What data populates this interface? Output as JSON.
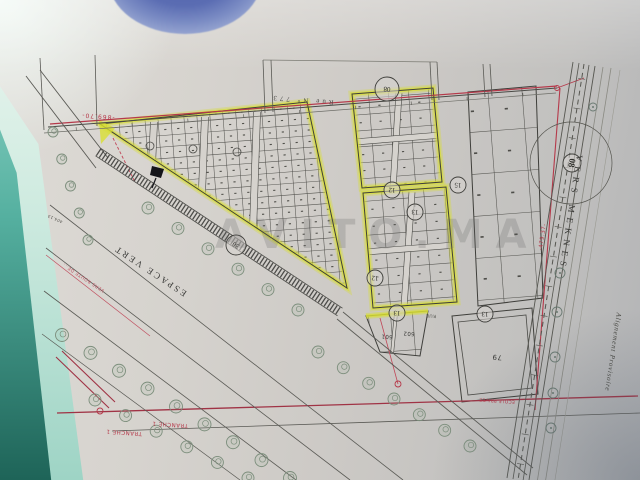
{
  "photo": {
    "watermark": "AVITO.MA",
    "colors": {
      "paper": "#d5d2cd",
      "ink": "#4a4a46",
      "red": "#b5394a",
      "highlighter_yellow": "#d8de33",
      "table_teal": "#2a7a6c",
      "blue_object": "#5b6db3",
      "tree_green": "#7c8e7c"
    }
  },
  "plan": {
    "grid_angle": -4.4,
    "labels": [
      {
        "id": "street-name-top",
        "text": "Rue N° 773",
        "x": 302,
        "y": 100,
        "rot": 184.4,
        "size": 7,
        "color": "#4a4a46",
        "ls": 3,
        "serif": true
      },
      {
        "id": "dimension-869-70",
        "text": "-869.70-",
        "x": 98,
        "y": 116,
        "rot": 184.4,
        "size": 6,
        "color": "#b5394a",
        "ls": 1
      },
      {
        "id": "road-to-meknes",
        "text": "VERS MEKNES",
        "x": 571,
        "y": 213,
        "rot": 98.5,
        "size": 9,
        "color": "#3a3a38",
        "ls": 5,
        "serif": true
      },
      {
        "id": "green-space-label",
        "text": "ESPACE VERT",
        "x": 150,
        "y": 271,
        "rot": 213.5,
        "size": 9,
        "color": "#3a3a38",
        "ls": 2.5,
        "serif": true
      },
      {
        "id": "phase-label-right",
        "text": "TRANCHE 1",
        "x": 170,
        "y": 424,
        "rot": 184,
        "size": 5.5,
        "color": "#b5394a",
        "ls": 0.5
      },
      {
        "id": "phase-label-left",
        "text": "TRANCHE 1",
        "x": 124,
        "y": 432,
        "rot": 184,
        "size": 5.5,
        "color": "#b5394a",
        "ls": 0.5
      },
      {
        "id": "alignment-note",
        "text": "Alignement Provisoire",
        "x": 613,
        "y": 352,
        "rot": 98.5,
        "size": 7,
        "color": "#45453f",
        "ls": 0.8,
        "italic": true,
        "serif": true
      },
      {
        "id": "dimension-479-37",
        "text": "-479.37-",
        "x": 543,
        "y": 237,
        "rot": 278.5,
        "size": 5.5,
        "color": "#b5394a",
        "ls": 0.5
      },
      {
        "id": "road-note-red",
        "text": "VERS ROUTE DE...",
        "x": 84,
        "y": 277,
        "rot": 213.5,
        "size": 4.5,
        "color": "#c05060",
        "ls": 0.5
      },
      {
        "id": "dimension-404-13",
        "text": "404.13",
        "x": 55,
        "y": 219,
        "rot": 204,
        "size": 4,
        "color": "#55554f",
        "ls": 0.3
      },
      {
        "id": "plot-601",
        "text": "601",
        "x": 387,
        "y": 336,
        "rot": 184,
        "size": 5.5,
        "color": "#3a3a38",
        "ls": 0.3
      },
      {
        "id": "plot-602",
        "text": "602",
        "x": 409,
        "y": 333,
        "rot": 184,
        "size": 5.5,
        "color": "#3a3a38",
        "ls": 0.3
      },
      {
        "id": "plot-79",
        "text": "79",
        "x": 497,
        "y": 357,
        "rot": 184,
        "size": 7,
        "color": "#3a3a38",
        "ls": 0.5
      },
      {
        "id": "school-caption",
        "text": "ECOLE PRIVEE",
        "x": 497,
        "y": 400,
        "rot": 184,
        "size": 4.5,
        "color": "#b5394a",
        "ls": 0.3
      },
      {
        "id": "street-label-small",
        "text": "RUE",
        "x": 431,
        "y": 315,
        "rot": 184,
        "size": 4.5,
        "color": "#55554f",
        "ls": 0.5
      }
    ],
    "circled_numbers": [
      {
        "x": 387,
        "y": 89,
        "label": "08",
        "r": 12,
        "rot": 184,
        "bold": false
      },
      {
        "x": 572,
        "y": 163,
        "label": "08",
        "r": 9,
        "rot": 99,
        "bold": true
      },
      {
        "x": 236,
        "y": 245,
        "label": "30",
        "r": 10,
        "rot": 213,
        "bold": false
      },
      {
        "x": 392,
        "y": 190,
        "label": "12",
        "r": 8,
        "rot": 184,
        "bold": false
      },
      {
        "x": 415,
        "y": 212,
        "label": "13",
        "r": 8,
        "rot": 184,
        "bold": false
      },
      {
        "x": 375,
        "y": 278,
        "label": "12",
        "r": 8,
        "rot": 184,
        "bold": false
      },
      {
        "x": 397,
        "y": 313,
        "label": "13",
        "r": 8,
        "rot": 184,
        "bold": false
      },
      {
        "x": 485,
        "y": 314,
        "label": "13",
        "r": 8,
        "rot": 184,
        "bold": false
      },
      {
        "x": 458,
        "y": 185,
        "label": "15",
        "r": 8,
        "rot": 184,
        "bold": false
      }
    ],
    "blocks": [
      {
        "name": "triangle-block",
        "points": [
          [
            100,
            124
          ],
          [
            307,
            102
          ],
          [
            347,
            288
          ]
        ],
        "yellow": true,
        "grid": {
          "cw": 13,
          "ch": 11.5
        },
        "dots": 1.1,
        "streets": [
          [
            154,
            122,
            146,
            290,
            7
          ],
          [
            205,
            117,
            198,
            290,
            7
          ],
          [
            257,
            112,
            251,
            290,
            7
          ]
        ]
      },
      {
        "name": "mid-block-upper",
        "points": [
          [
            352,
            94
          ],
          [
            433,
            88
          ],
          [
            442,
            182
          ],
          [
            362,
            188
          ]
        ],
        "yellow": true,
        "grid": {
          "cw": 20,
          "ch": 16
        },
        "dots": 1.1,
        "streets": [
          [
            399,
            93,
            393,
            188,
            6
          ],
          [
            354,
            142,
            442,
            135,
            6
          ]
        ]
      },
      {
        "name": "mid-block-lower",
        "points": [
          [
            363,
            193
          ],
          [
            446,
            187
          ],
          [
            457,
            302
          ],
          [
            373,
            308
          ]
        ],
        "yellow": true,
        "grid": {
          "cw": 21,
          "ch": 17
        },
        "dots": 1.1,
        "streets": [
          [
            412,
            192,
            404,
            307,
            6
          ],
          [
            365,
            252,
            456,
            245,
            6
          ]
        ]
      },
      {
        "name": "right-block-large-plots",
        "points": [
          [
            468,
            92
          ],
          [
            536,
            86
          ],
          [
            543,
            298
          ],
          [
            478,
            306
          ]
        ],
        "yellow": false,
        "grid": {
          "cw": 34,
          "ch": 42
        },
        "dots": 1.6,
        "streets": []
      },
      {
        "name": "small-triangle-block",
        "points": [
          [
            366,
            316
          ],
          [
            428,
            311
          ],
          [
            420,
            356
          ],
          [
            380,
            352
          ]
        ],
        "yellow": false,
        "grid": {
          "cw": 22,
          "ch": 40
        },
        "dots": 0,
        "streets": [
          [
            396,
            313,
            392,
            354,
            3
          ]
        ]
      },
      {
        "name": "school-plot",
        "points": [
          [
            452,
            316
          ],
          [
            532,
            308
          ],
          [
            538,
            394
          ],
          [
            462,
            402
          ]
        ],
        "yellow": false,
        "grid": null,
        "dots": 0,
        "streets": [],
        "inner": [
          [
            458,
            322
          ],
          [
            526,
            315
          ],
          [
            532,
            388
          ],
          [
            468,
            395
          ]
        ]
      }
    ],
    "yellow_lines": [
      [
        366,
        316,
        428,
        311
      ]
    ],
    "yellow_wedge": [
      [
        99,
        120
      ],
      [
        115,
        128
      ],
      [
        101,
        144
      ]
    ],
    "lines": [
      [
        48,
        127,
        557,
        88,
        1,
        "#4a4a46",
        ""
      ],
      [
        44,
        133,
        556,
        93,
        0.7,
        "#6e6e68",
        ""
      ],
      [
        50,
        124,
        557,
        86,
        1.2,
        "#b5394a",
        ""
      ],
      [
        557,
        88,
        584,
        78,
        0.9,
        "#b5394a",
        ""
      ],
      [
        560,
        88,
        535,
        410,
        1.1,
        "#b5394a",
        ""
      ],
      [
        57,
        413,
        638,
        396,
        1.3,
        "#a03345",
        ""
      ],
      [
        56,
        357,
        109,
        408,
        1.1,
        "#a03345",
        ""
      ],
      [
        62,
        351,
        115,
        402,
        1.1,
        "#a03345",
        ""
      ],
      [
        112,
        431,
        640,
        413,
        0.8,
        "#5a5a55",
        ""
      ],
      [
        50,
        205,
        403,
        480,
        0.8,
        "#5a5a55",
        ""
      ],
      [
        46,
        248,
        350,
        480,
        0.8,
        "#5a5a55",
        ""
      ],
      [
        44,
        291,
        296,
        480,
        0.8,
        "#5a5a55",
        ""
      ],
      [
        42,
        334,
        240,
        480,
        0.7,
        "#5a5a55",
        ""
      ],
      [
        46,
        255,
        150,
        336,
        0.7,
        "#c05060",
        ""
      ],
      [
        26,
        76,
        96,
        168,
        0.9,
        "#5a5a55",
        ""
      ],
      [
        40,
        70,
        108,
        158,
        0.9,
        "#5a5a55",
        ""
      ],
      [
        263,
        60,
        437,
        62,
        0.7,
        "#77776f",
        ""
      ],
      [
        40,
        58,
        44,
        130,
        0.8,
        "#5a5a55",
        ""
      ],
      [
        95,
        55,
        97,
        126,
        0.8,
        "#5a5a55",
        ""
      ],
      [
        263,
        60,
        265,
        113,
        0.8,
        "#5a5a55",
        ""
      ],
      [
        271,
        60,
        273,
        112,
        0.8,
        "#5a5a55",
        ""
      ],
      [
        430,
        62,
        432,
        100,
        0.8,
        "#5a5a55",
        ""
      ],
      [
        437,
        62,
        439,
        100,
        0.8,
        "#5a5a55",
        ""
      ],
      [
        483,
        64,
        485,
        97,
        0.8,
        "#5a5a55",
        ""
      ],
      [
        490,
        64,
        492,
        96,
        0.8,
        "#5a5a55",
        ""
      ],
      [
        380,
        318,
        398,
        384,
        0.8,
        "#c04556",
        ""
      ],
      [
        113,
        138,
        135,
        182,
        0.9,
        "#c04556",
        "3 2"
      ],
      [
        337,
        319,
        527,
        475,
        0.9,
        "#5a5a55",
        ""
      ],
      [
        343,
        312,
        533,
        468,
        0.9,
        "#5a5a55",
        ""
      ],
      [
        595,
        66,
        529,
        480,
        0.9,
        "#55554f",
        ""
      ],
      [
        589,
        65,
        523,
        481,
        0.8,
        "#55554f",
        ""
      ],
      [
        584,
        64,
        518,
        480,
        1,
        "#55554f",
        "5 4"
      ],
      [
        579,
        63,
        513,
        479,
        0.8,
        "#55554f",
        ""
      ],
      [
        573,
        62,
        507,
        478,
        0.9,
        "#55554f",
        ""
      ],
      [
        603,
        67,
        537,
        483,
        0.8,
        "#8a8a82",
        ""
      ],
      [
        611,
        68,
        545,
        484,
        0.8,
        "#8a8a82",
        ""
      ],
      [
        620,
        70,
        554,
        486,
        0.6,
        "#9a9a92",
        ""
      ],
      [
        95.5,
        155.8,
        337.5,
        315.8,
        0.8,
        "#4a4a46",
        ""
      ],
      [
        100.5,
        148.2,
        342.5,
        308.2,
        0.8,
        "#4a4a46",
        ""
      ]
    ],
    "hatch_strip": {
      "p1": [
        98,
        152
      ],
      "p2": [
        340,
        312
      ],
      "width": 8,
      "dash": "1.3 2.2",
      "color": "#3a3a38"
    },
    "ticks": [
      {
        "p": [
          584,
          64,
          518,
          480
        ],
        "step": 30,
        "len": 7,
        "w": 0.6,
        "c": "#55554f",
        "off": 0
      },
      {
        "p": [
          48,
          127,
          557,
          88
        ],
        "step": 56,
        "len": 3.5,
        "w": 0.6,
        "c": "#55554f",
        "off": 4
      }
    ],
    "tree_rows": [
      [
        53,
        132,
        88,
        240,
        5,
        5
      ],
      [
        148,
        208,
        298,
        310,
        6,
        6
      ],
      [
        318,
        352,
        470,
        446,
        7,
        6
      ],
      [
        62,
        335,
        290,
        478,
        9,
        6.5
      ],
      [
        95,
        400,
        248,
        478,
        6,
        6
      ]
    ],
    "bushes": [
      [
        593,
        107,
        4
      ],
      [
        560,
        273,
        5
      ],
      [
        557,
        312,
        5
      ],
      [
        555,
        357,
        5
      ],
      [
        553,
        393,
        5
      ],
      [
        551,
        428,
        5
      ]
    ],
    "big_circle": [
      571,
      163,
      41
    ],
    "small_circles": [
      [
        150,
        146,
        4
      ],
      [
        193,
        149,
        4
      ],
      [
        237,
        152,
        4
      ]
    ],
    "red_circles": [
      [
        557,
        88,
        2.5
      ],
      [
        100,
        411,
        3
      ],
      [
        398,
        384,
        3
      ]
    ],
    "flag_marker": {
      "poly": [
        [
          152,
          166
        ],
        [
          164,
          169
        ],
        [
          161,
          178
        ],
        [
          150,
          175
        ]
      ],
      "stem": [
        156,
        178,
        152,
        188
      ]
    }
  }
}
